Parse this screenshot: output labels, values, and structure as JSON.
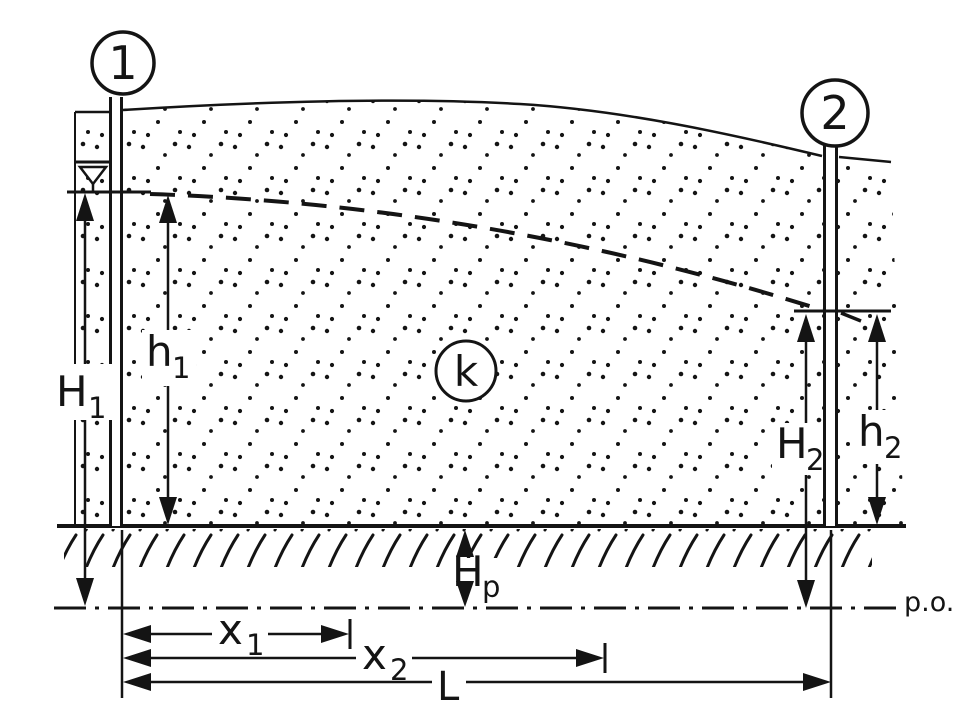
{
  "diagram": {
    "well_labels": {
      "well1": "1",
      "well2": "2"
    },
    "soil_permeability_label": "k",
    "reference_plane_label": "p.o.",
    "dimension_labels": {
      "H1": {
        "base": "H",
        "sub": "1"
      },
      "h1": {
        "base": "h",
        "sub": "1"
      },
      "H2": {
        "base": "H",
        "sub": "2"
      },
      "h2": {
        "base": "h",
        "sub": "2"
      },
      "Hp": {
        "base": "H",
        "sub": "p"
      },
      "x1": {
        "base": "x",
        "sub": "1"
      },
      "x2": {
        "base": "x",
        "sub": "2"
      },
      "L": {
        "base": "L",
        "sub": ""
      }
    },
    "colors": {
      "ink": "#141414",
      "paper": "#ffffff"
    }
  }
}
